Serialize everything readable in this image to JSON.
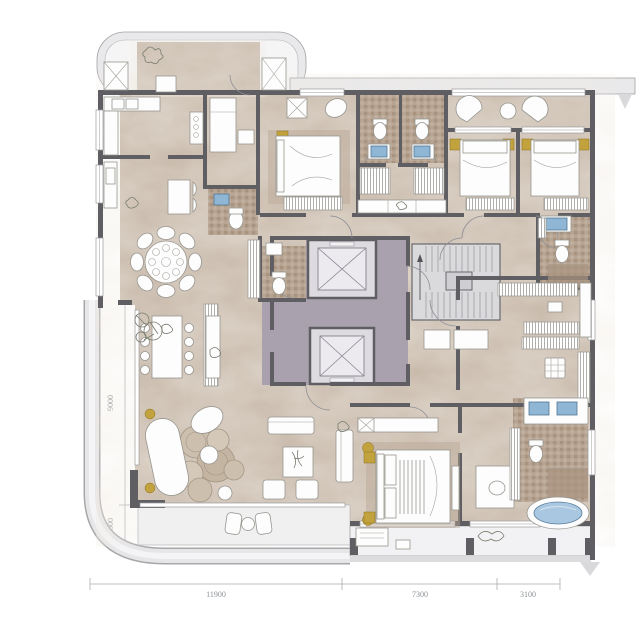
{
  "title": "residential-floor-plan",
  "dimensions": {
    "left": [
      {
        "label": "2050"
      },
      {
        "label": "9200"
      },
      {
        "label": "9000"
      },
      {
        "label": "1800"
      }
    ],
    "bottom": [
      {
        "label": "11900"
      },
      {
        "label": "7300"
      },
      {
        "label": "3100"
      }
    ]
  },
  "colors": {
    "floor": "#c6b7a8",
    "wall": "#5f5e62",
    "lobby_floor": "#a9a2ae",
    "elevator_cab": "#dddbe0",
    "balcony": "#e9e9eb",
    "tile": "#b4a18f",
    "fixture_blue": "#8fb6d4",
    "tub_blue": "#a9c7e0",
    "gold": "#c2a23c",
    "dim_line": "#a9adb0",
    "dim_text": "#8d9296"
  }
}
